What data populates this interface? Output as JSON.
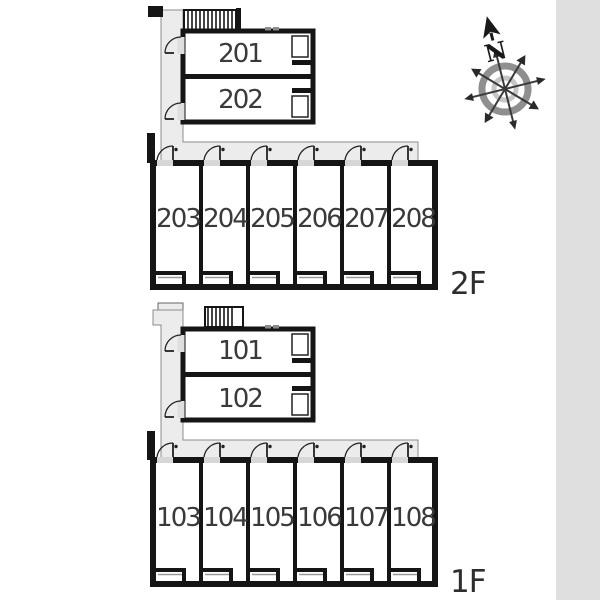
{
  "floors": [
    {
      "label": "2F",
      "upper_rooms": [
        "201",
        "202"
      ],
      "strip_rooms": [
        "203",
        "204",
        "205",
        "206",
        "207",
        "208"
      ]
    },
    {
      "label": "1F",
      "upper_rooms": [
        "101",
        "102"
      ],
      "strip_rooms": [
        "103",
        "104",
        "105",
        "106",
        "107",
        "108"
      ]
    }
  ],
  "compass": {
    "north_label": "N"
  },
  "colors": {
    "wall": "#151515",
    "corridor_fill": "#ececec",
    "corridor_edge": "#8c8c8c",
    "side_band": "#dfdfdf",
    "door_opening": "#d7d7d7",
    "window_line": "#999999",
    "compass_ring_outer": "#8f8f8f",
    "compass_ring_inner": "#c6c6c6",
    "label_text": "#3a3a3a"
  },
  "icons": {
    "compass": "compass-rose-icon",
    "stairs": "stairs-hatch-icon",
    "door": "door-swing-icon",
    "balcony": "balcony-step"
  }
}
